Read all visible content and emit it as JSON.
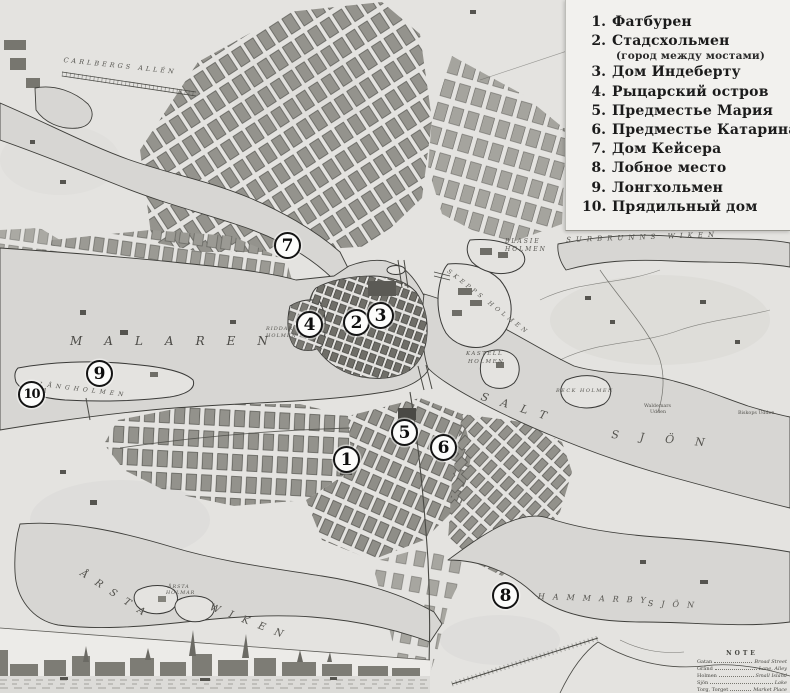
{
  "title": "Historical map of Stockholm with numbered Russian legend",
  "colors": {
    "paper": "#e4e3e0",
    "water": "#d7d6d3",
    "block_gray": "#8f8e88",
    "ink": "#2f2f2c",
    "legend_bg": "#f2f1ee",
    "marker_fill": "#fcfcfb",
    "marker_ring": "#141414"
  },
  "legend": {
    "items": [
      {
        "num": "1.",
        "label": "Фатбурен"
      },
      {
        "num": "2.",
        "label": "Стадсхольмен",
        "sub": "(город между мостами)"
      },
      {
        "num": "3.",
        "label": "Дом Индеберту"
      },
      {
        "num": "4.",
        "label": "Рыцарский остров"
      },
      {
        "num": "5.",
        "label": "Предместье Мария"
      },
      {
        "num": "6.",
        "label": "Предместье Катарина"
      },
      {
        "num": "7.",
        "label": "Дом Кейсера"
      },
      {
        "num": "8.",
        "label": "Лобное место"
      },
      {
        "num": "9.",
        "label": "Лонгхольмен"
      },
      {
        "num": "10.",
        "label": "Прядильный дом"
      }
    ]
  },
  "markers": [
    {
      "number": "1"
    },
    {
      "number": "2"
    },
    {
      "number": "3"
    },
    {
      "number": "4"
    },
    {
      "number": "5"
    },
    {
      "number": "6"
    },
    {
      "number": "7"
    },
    {
      "number": "8"
    },
    {
      "number": "9"
    },
    {
      "number": "10"
    }
  ],
  "map": {
    "labels": {
      "malaren": "MALAREN",
      "salt": "SALT",
      "sjon_salt": "SJÖN",
      "surbrunns": "SURBRUNNS WIKEN",
      "arsta": "ÅRSTA",
      "wiken": "WIKEN",
      "hammarby": "HAMMARBY",
      "sjon_hammarby": "SJÖN",
      "langholmen": "LÅNGHOLMEN",
      "carlbergs": "CARLBERGS ALLÉN",
      "blasie_1": "BLASIE",
      "blasie_2": "HOLMEN",
      "skepps": "SKEPPS HOLMEN",
      "kastell_1": "KASTELL",
      "kastell_2": "HOLMEN",
      "riddar_1": "RIDDAR",
      "riddar_2": "HOLMEN",
      "beck": "BECK HOLMEN",
      "arstaholmar_1": "ÅRSTA",
      "arstaholmar_2": "HOLMAR",
      "waldemars_1": "Waldemars",
      "waldemars_2": "Udden",
      "biskops": "Biskops Udden"
    }
  },
  "note": {
    "title": "NOTE",
    "rows": [
      {
        "term": "Gatan",
        "meaning": "Broad Street"
      },
      {
        "term": "Gränd",
        "meaning": "Lane, Alley"
      },
      {
        "term": "Holmen",
        "meaning": "Small Island"
      },
      {
        "term": "Sjön",
        "meaning": "Lake"
      },
      {
        "term": "Torg, Torget",
        "meaning": "Market Place"
      }
    ]
  }
}
